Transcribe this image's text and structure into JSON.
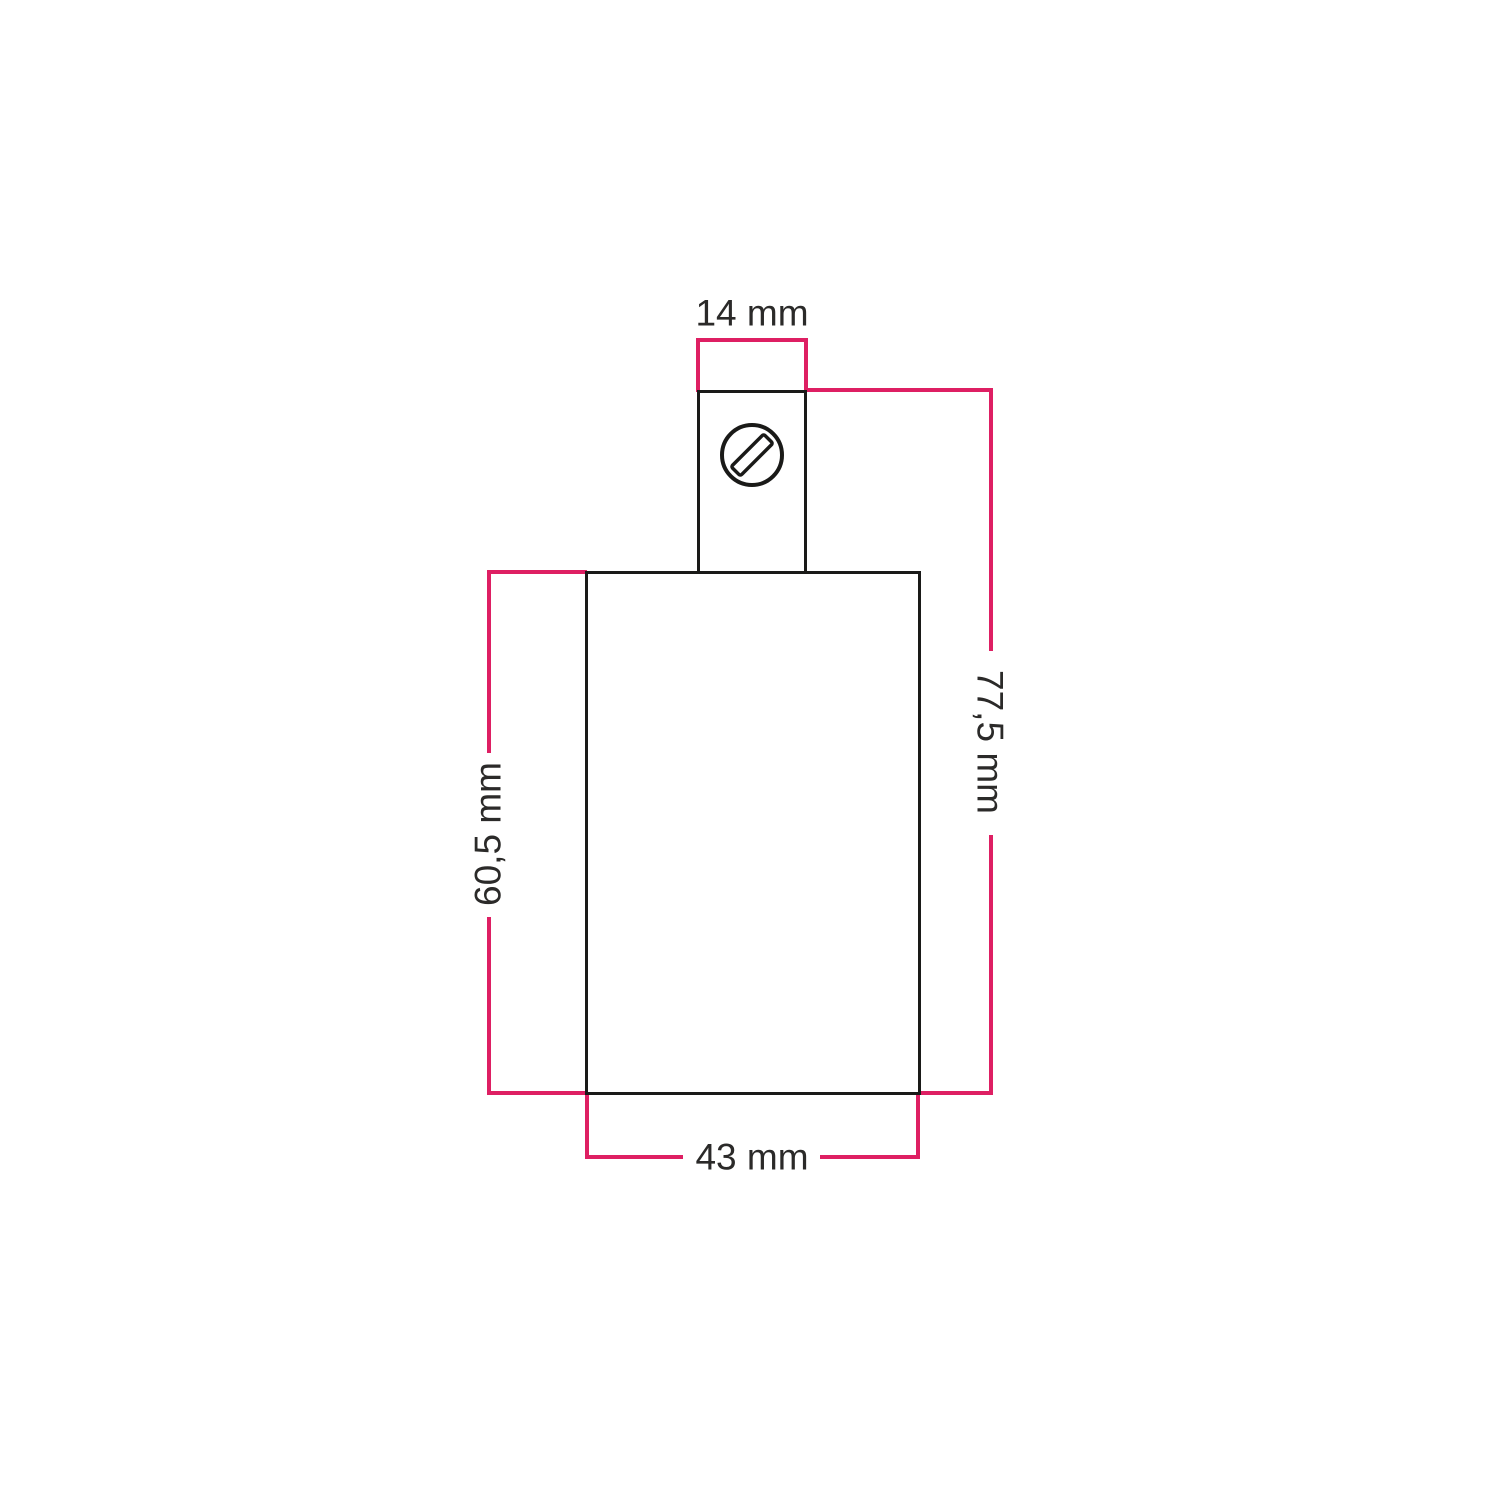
{
  "diagram": {
    "kind": "technical-dimension-drawing",
    "units": "mm",
    "dimensions": {
      "top_width": {
        "label": "14 mm",
        "value": 14
      },
      "total_height": {
        "label": "77,5 mm",
        "value": 77.5
      },
      "body_height": {
        "label": "60,5 mm",
        "value": 60.5
      },
      "body_width": {
        "label": "43 mm",
        "value": 43
      }
    },
    "icons": {
      "screw": "slotted-screw-head-icon"
    },
    "colors": {
      "background": "#ffffff",
      "outline": "#1a1a18",
      "dimension": "#de1f63",
      "text": "#2b2a29"
    }
  }
}
